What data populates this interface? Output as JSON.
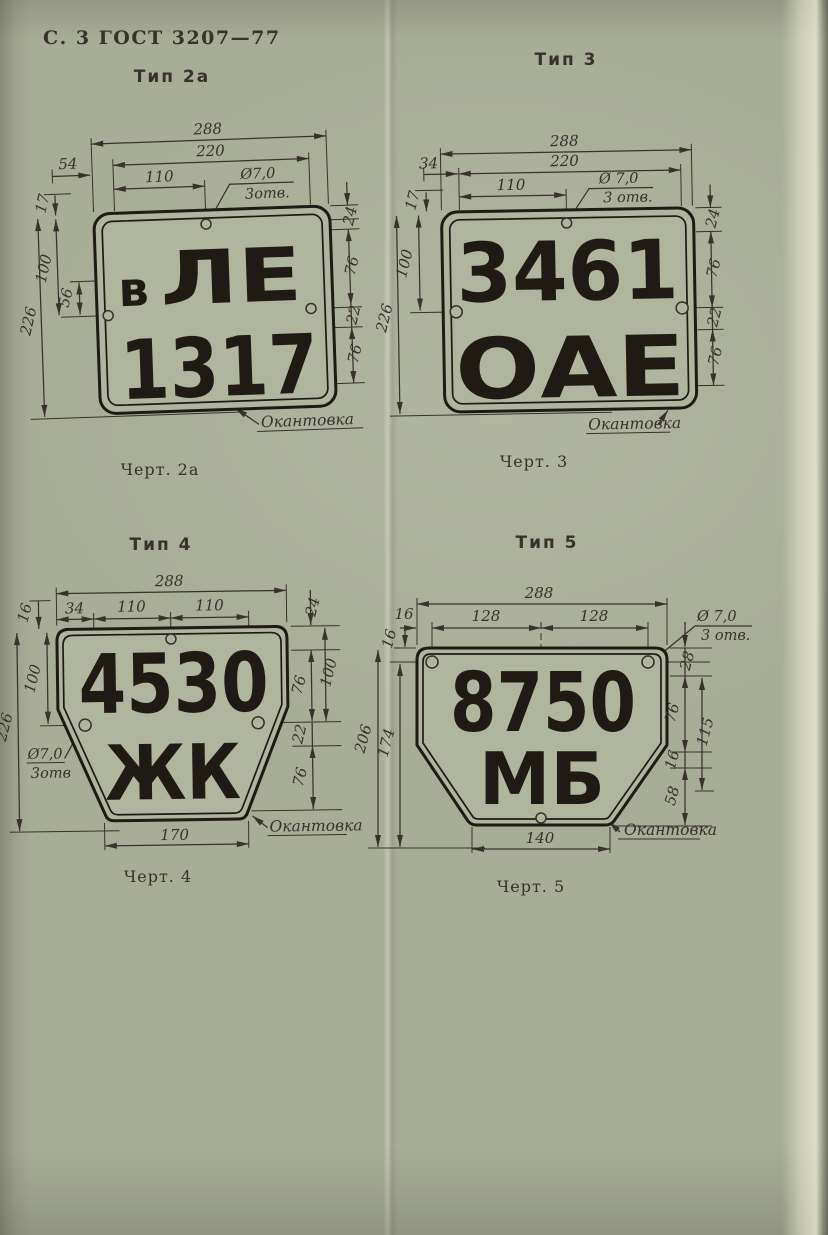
{
  "page": {
    "header": "С. 3 ГОСТ 3207—77"
  },
  "colors": {
    "paper": "#a8ad96",
    "ink": "#38322a",
    "letters": "#1f1a13",
    "plate": "#b0b59d"
  },
  "figures": {
    "f2a": {
      "type_label": "Тип 2а",
      "caption": "Черт. 2а",
      "plate": {
        "prefix": "в",
        "row1": "ЛЕ",
        "row2": "1317"
      },
      "hole_note": {
        "dia": "Ø7,0",
        "count": "3отв."
      },
      "border_label": "Окантовка",
      "dims": {
        "w_total": "288",
        "w_inner": "220",
        "w_half": "110",
        "left_offset": "54",
        "top_margin": "17",
        "h_total": "226",
        "h_upper": "100",
        "h_hole": "56",
        "r_top": "24",
        "r_row1": "76",
        "r_gap": "22",
        "r_row2": "76"
      }
    },
    "f3": {
      "type_label": "Тип 3",
      "caption": "Черт. 3",
      "plate": {
        "row1": "3461",
        "row2": "ОАЕ"
      },
      "hole_note": {
        "dia": "Ø 7,0",
        "count": "3 отв."
      },
      "border_label": "Окантовка",
      "dims": {
        "w_total": "288",
        "w_inner": "220",
        "w_half": "110",
        "left_offset": "34",
        "top_margin": "17",
        "h_total": "226",
        "h_upper": "100",
        "r_top": "24",
        "r_row1": "76",
        "r_gap": "22",
        "r_row2": "76"
      }
    },
    "f4": {
      "type_label": "Тип 4",
      "caption": "Черт. 4",
      "plate": {
        "row1": "4530",
        "row2": "ЖК"
      },
      "hole_note": {
        "dia": "Ø7,0",
        "count": "3отв"
      },
      "border_label": "Окантовка",
      "dims": {
        "w_total": "288",
        "left_offset": "34",
        "w_half1": "110",
        "w_half2": "110",
        "top_margin": "16",
        "r_top": "24",
        "h_total": "226",
        "h_upper": "100",
        "r_row1": "76",
        "r_upper": "100",
        "r_gap": "22",
        "r_row2": "76",
        "w_bottom": "170"
      }
    },
    "f5": {
      "type_label": "Тип 5",
      "caption": "Черт. 5",
      "plate": {
        "row1": "8750",
        "row2": "МБ"
      },
      "hole_note": {
        "dia": "Ø 7,0",
        "count": "3 отв."
      },
      "border_label": "Окантовка",
      "dims": {
        "w_total": "288",
        "w_half1": "128",
        "w_half2": "128",
        "left_offset": "16",
        "top_margin": "16",
        "h_total": "206",
        "h_lower": "174",
        "r_top": "28",
        "r_row1": "76",
        "r_mid": "115",
        "r_gap": "16",
        "r_row2": "58",
        "w_bottom": "140"
      }
    }
  }
}
